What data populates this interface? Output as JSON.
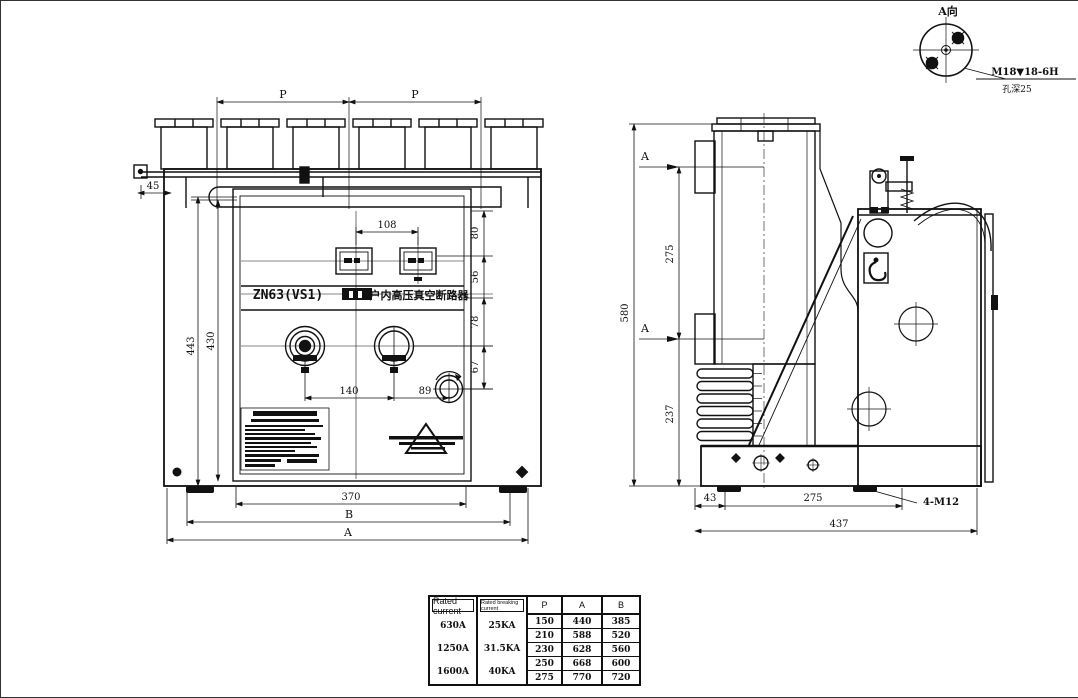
{
  "detail_a": {
    "title": "A向",
    "thread": "M18▼18-6H",
    "depth": "孔深25"
  },
  "front": {
    "model": "ZN63(VS1)",
    "product_name": "户内高压真空断路器",
    "dim_p_left": "P",
    "dim_p_right": "P",
    "dim_45": "45",
    "dim_108": "108",
    "dim_80": "80",
    "dim_56": "56",
    "dim_78": "78",
    "dim_67": "67",
    "dim_443": "443",
    "dim_430": "430",
    "dim_140": "140",
    "dim_89": "89",
    "dim_370": "370",
    "dim_b": "B",
    "dim_a": "A"
  },
  "side": {
    "dim_580": "580",
    "dim_275_vertical": "275",
    "dim_237": "237",
    "dim_43": "43",
    "dim_275_bottom": "275",
    "dim_437": "437",
    "bolt_note": "4-M12",
    "section_upper": "A",
    "section_lower": "A"
  },
  "table": {
    "headers": {
      "rated_current": "Rated current",
      "breaking_current": "Rated breaking current",
      "p": "P",
      "a": "A",
      "b": "B"
    },
    "rated_current": [
      "630A",
      "1250A",
      "1600A"
    ],
    "breaking_current": [
      "25KA",
      "31.5KA",
      "40KA"
    ],
    "rows": [
      [
        "150",
        "440",
        "385"
      ],
      [
        "210",
        "588",
        "520"
      ],
      [
        "230",
        "628",
        "560"
      ],
      [
        "250",
        "668",
        "600"
      ],
      [
        "275",
        "770",
        "720"
      ]
    ]
  }
}
